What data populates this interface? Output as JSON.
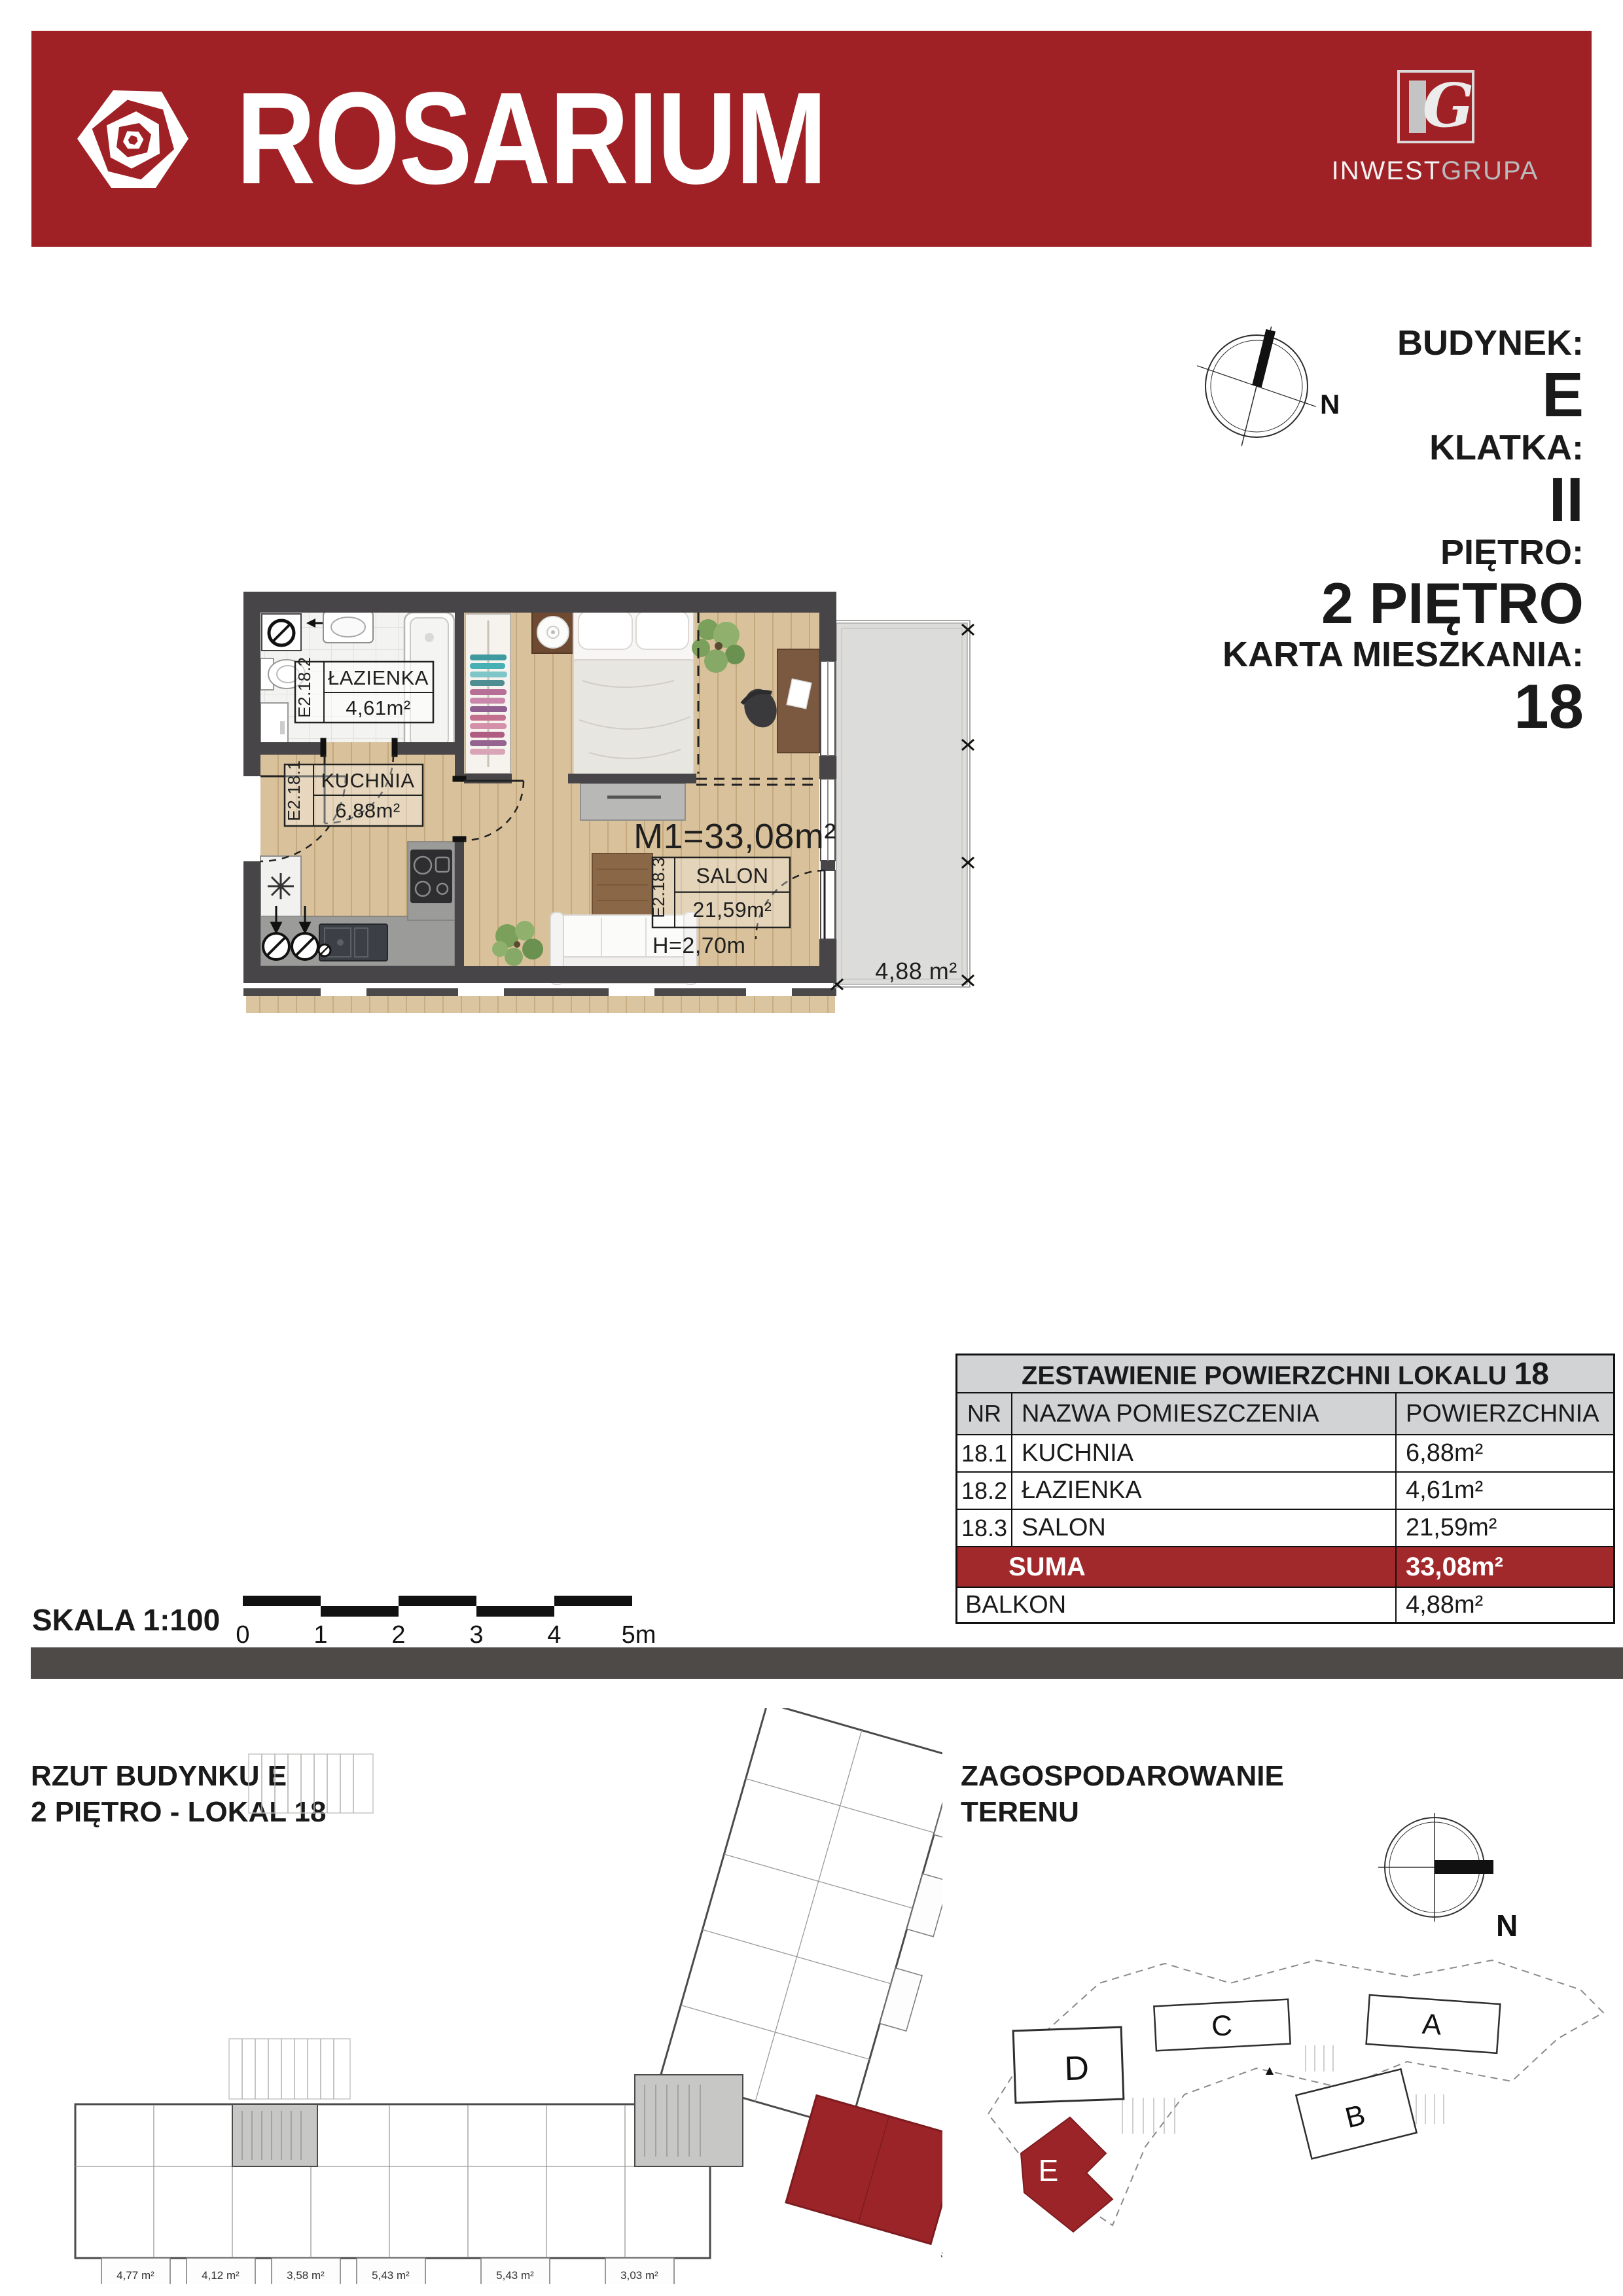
{
  "header": {
    "brand": "ROSARIUM",
    "logo": {
      "monogram_i": "I",
      "monogram_g": "G",
      "inwest": "INWEST",
      "grupa": "GRUPA"
    }
  },
  "info": {
    "budynek_label": "BUDYNEK:",
    "budynek": "E",
    "klatka_label": "KLATKA:",
    "klatka": "II",
    "pietro_label": "PIĘTRO:",
    "pietro": "2 PIĘTRO",
    "karta_label": "KARTA MIESZKANIA:",
    "karta": "18",
    "compass_n": "N"
  },
  "plan": {
    "m1": "M1=33,08m²",
    "rooms": [
      {
        "id": "E2.18.2",
        "name": "ŁAZIENKA",
        "area": "4,61m²"
      },
      {
        "id": "E2.18.1",
        "name": "KUCHNIA",
        "area": "6,88m²"
      },
      {
        "id": "E2.18.3",
        "name": "SALON",
        "area": "21,59m²"
      }
    ],
    "height": "H=2,70m",
    "balcony_area": "4,88 m²"
  },
  "table": {
    "title": "ZESTAWIENIE POWIERZCHNI LOKALU",
    "title_number": "18",
    "headers": [
      "NR",
      "NAZWA POMIESZCZENIA",
      "POWIERZCHNIA"
    ],
    "rows": [
      {
        "nr": "18.1",
        "name": "KUCHNIA",
        "area": "6,88m²"
      },
      {
        "nr": "18.2",
        "name": "ŁAZIENKA",
        "area": "4,61m²"
      },
      {
        "nr": "18.3",
        "name": "SALON",
        "area": "21,59m²"
      }
    ],
    "suma_label": "SUMA",
    "suma_value": "33,08m²",
    "balkon_label": "BALKON",
    "balkon_value": "4,88m²"
  },
  "scale": {
    "label": "SKALA 1:100",
    "ticks": [
      "0",
      "1",
      "2",
      "3",
      "4",
      "5m"
    ]
  },
  "bottom_left": {
    "line1": "RZUT BUDYNKU E",
    "line2": "2 PIĘTRO - LOKAL 18"
  },
  "building_plan": {
    "balcony_areas": [
      "4,77 m²",
      "4,12 m²",
      "3,58 m²",
      "5,43 m²",
      "5,43 m²",
      "3,03 m²",
      "5,44 m²"
    ]
  },
  "site": {
    "line1": "ZAGOSPODAROWANIE",
    "line2": "TERENU",
    "buildings": {
      "a": "A",
      "b": "B",
      "c": "C",
      "d": "D",
      "e": "E"
    },
    "compass_n": "N"
  },
  "colors": {
    "brand_red": "#a02125",
    "highlight_red": "#9b2428",
    "suma_red": "#a1292c",
    "table_header_bg": "#d2d3d5",
    "divider_gray": "#4d4a48"
  }
}
